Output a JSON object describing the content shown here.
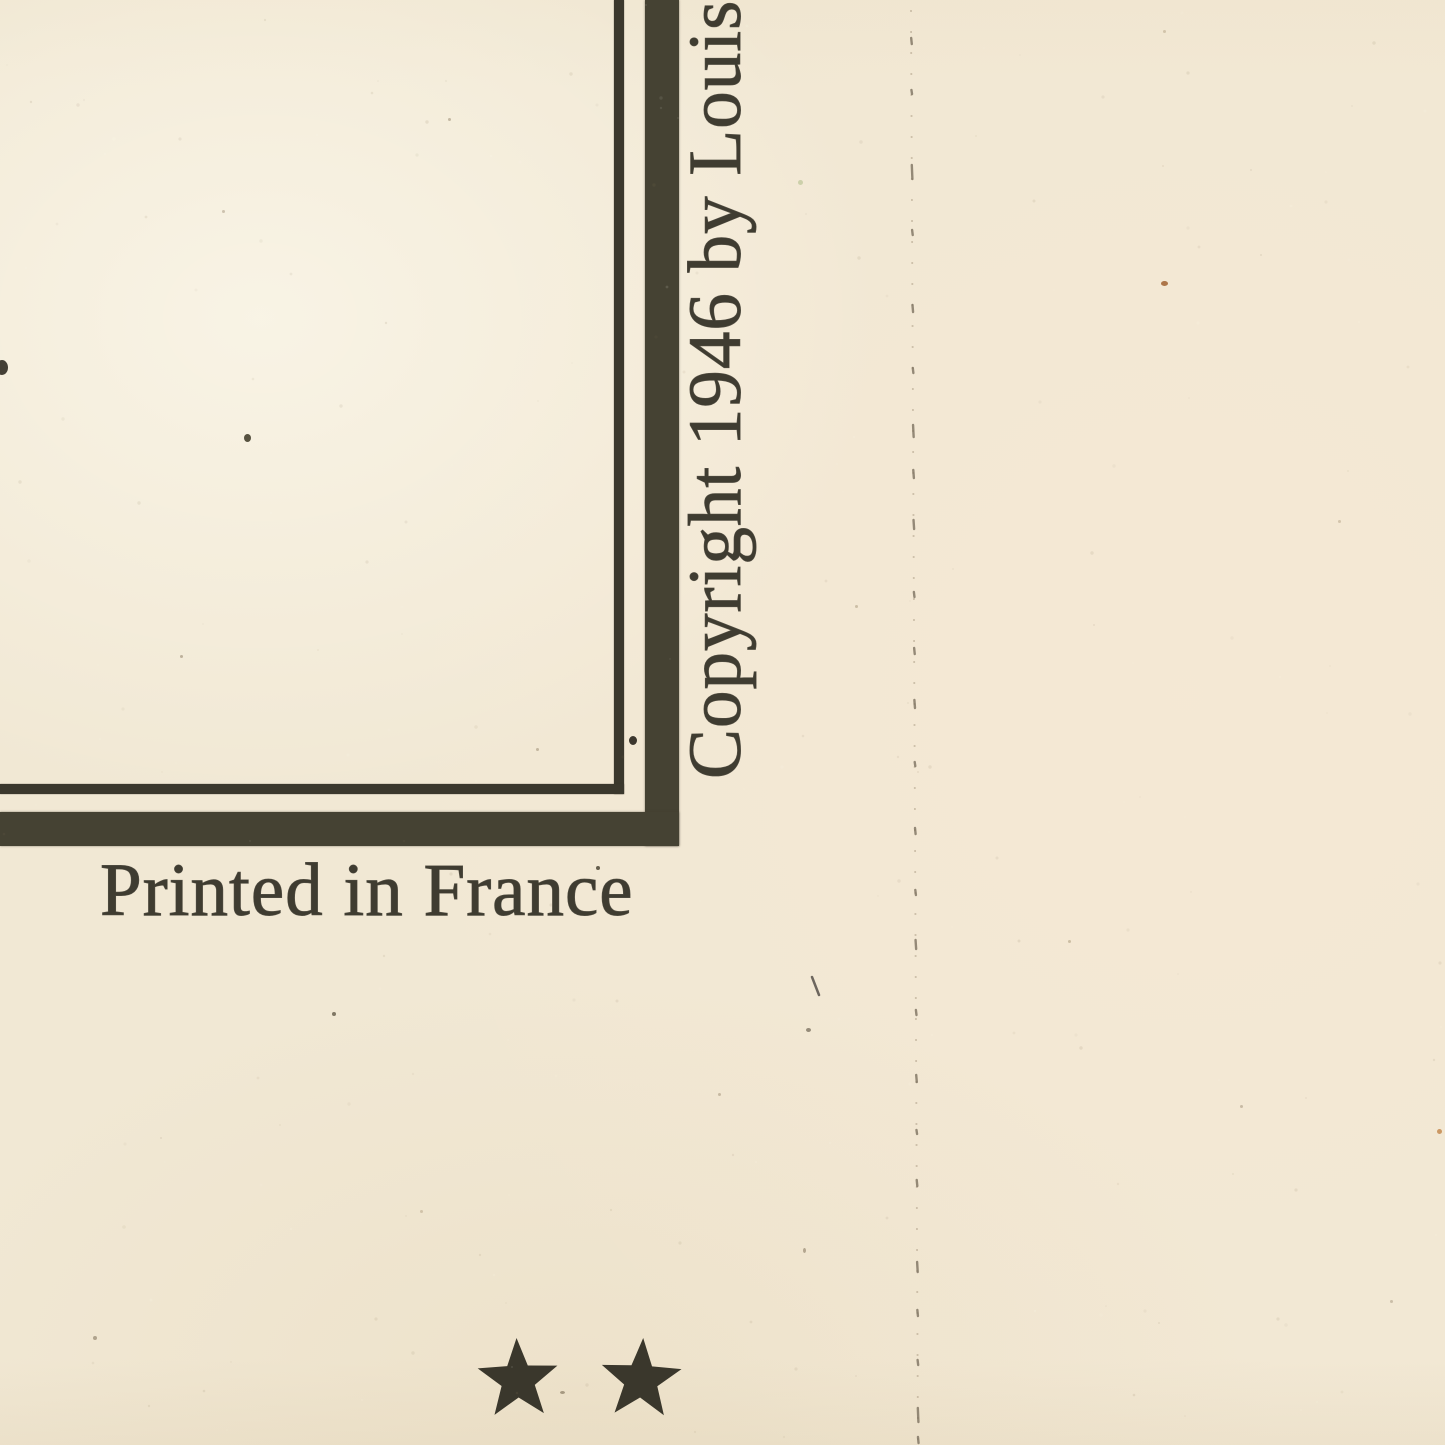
{
  "document": {
    "description": "Scanned bottom-right corner of a vintage printed map sheet",
    "copyright_notice": "Copyright 1946 by Louis",
    "imprint": "Printed in France",
    "stars": {
      "count": 2,
      "symbol": "★",
      "rotations_deg": [
        -2,
        3
      ]
    }
  },
  "colors": {
    "paper": "#f1e8d4",
    "paper_light": "#f7f1e2",
    "paper_warm": "#f5ebd7",
    "ink_text": "#3f3c31",
    "ink_border": "#454233",
    "ink_thin": "#3b382d",
    "star_ink": "#3a372c",
    "fold_dot": "#a3927a",
    "fold_dash": "#7d7260"
  },
  "artifacts": {
    "fold_line": {
      "x_top": 911,
      "x_bottom": 918,
      "dashes": [
        [
          38,
          6
        ],
        [
          90,
          4
        ],
        [
          165,
          14
        ],
        [
          230,
          5
        ],
        [
          305,
          7
        ],
        [
          368,
          5
        ],
        [
          425,
          12
        ],
        [
          470,
          8
        ],
        [
          520,
          9
        ],
        [
          592,
          5
        ],
        [
          648,
          6
        ],
        [
          700,
          8
        ],
        [
          762,
          4
        ],
        [
          828,
          6
        ],
        [
          890,
          5
        ],
        [
          940,
          9
        ],
        [
          1010,
          5
        ],
        [
          1075,
          7
        ],
        [
          1130,
          4
        ],
        [
          1180,
          6
        ],
        [
          1262,
          10
        ],
        [
          1310,
          6
        ],
        [
          1360,
          5
        ],
        [
          1408,
          14
        ],
        [
          1437,
          6
        ]
      ]
    },
    "scratch": {
      "x1": 812,
      "y1": 977,
      "x2": 819,
      "y2": 995,
      "color": "#56504a",
      "width": 2.5
    },
    "specks": [
      {
        "x": 244,
        "y": 434,
        "w": 7,
        "h": 8,
        "c": "#45402f",
        "o": 0.9
      },
      {
        "x": -4,
        "y": 360,
        "w": 12,
        "h": 15,
        "c": "#3a362c",
        "o": 0.95
      },
      {
        "x": 629,
        "y": 736,
        "w": 8,
        "h": 9,
        "c": "#312d25",
        "o": 0.95
      },
      {
        "x": 596,
        "y": 866,
        "w": 4,
        "h": 4,
        "c": "#554f3e",
        "o": 0.9
      },
      {
        "x": 1161,
        "y": 281,
        "w": 7,
        "h": 5,
        "c": "#a5693a",
        "o": 0.9
      },
      {
        "x": 1437,
        "y": 1129,
        "w": 5,
        "h": 5,
        "c": "#c08347",
        "o": 0.8
      },
      {
        "x": 798,
        "y": 180,
        "w": 5,
        "h": 5,
        "c": "#c8cda5",
        "o": 0.9
      },
      {
        "x": 332,
        "y": 1012,
        "w": 4,
        "h": 4,
        "c": "#6d6452",
        "o": 0.85
      },
      {
        "x": 806,
        "y": 1028,
        "w": 5,
        "h": 4,
        "c": "#6d6452",
        "o": 0.7
      },
      {
        "x": 803,
        "y": 1248,
        "w": 3,
        "h": 5,
        "c": "#8a7c64",
        "o": 0.6
      },
      {
        "x": 560,
        "y": 1391,
        "w": 5,
        "h": 3,
        "c": "#897b63",
        "o": 0.7
      },
      {
        "x": 536,
        "y": 748,
        "w": 3,
        "h": 3,
        "c": "#a3947b",
        "o": 0.6
      },
      {
        "x": 180,
        "y": 655,
        "w": 3,
        "h": 3,
        "c": "#998b72",
        "o": 0.6
      },
      {
        "x": 448,
        "y": 118,
        "w": 3,
        "h": 3,
        "c": "#9a8c72",
        "o": 0.55
      },
      {
        "x": 1240,
        "y": 1105,
        "w": 3,
        "h": 3,
        "c": "#a4947c",
        "o": 0.55
      },
      {
        "x": 1068,
        "y": 940,
        "w": 3,
        "h": 3,
        "c": "#b3a184",
        "o": 0.6
      },
      {
        "x": 93,
        "y": 1336,
        "w": 4,
        "h": 4,
        "c": "#8d8069",
        "o": 0.65
      },
      {
        "x": 718,
        "y": 1093,
        "w": 3,
        "h": 3,
        "c": "#a4947c",
        "o": 0.55
      },
      {
        "x": 1338,
        "y": 520,
        "w": 3,
        "h": 3,
        "c": "#b3a184",
        "o": 0.5
      },
      {
        "x": 222,
        "y": 210,
        "w": 3,
        "h": 3,
        "c": "#a4947c",
        "o": 0.5
      },
      {
        "x": 855,
        "y": 605,
        "w": 3,
        "h": 3,
        "c": "#ab9a80",
        "o": 0.55
      },
      {
        "x": 1390,
        "y": 1300,
        "w": 3,
        "h": 3,
        "c": "#a4947c",
        "o": 0.5
      },
      {
        "x": 1163,
        "y": 30,
        "w": 3,
        "h": 3,
        "c": "#b3a184",
        "o": 0.5
      },
      {
        "x": 420,
        "y": 1210,
        "w": 3,
        "h": 3,
        "c": "#b3a184",
        "o": 0.5
      }
    ]
  }
}
